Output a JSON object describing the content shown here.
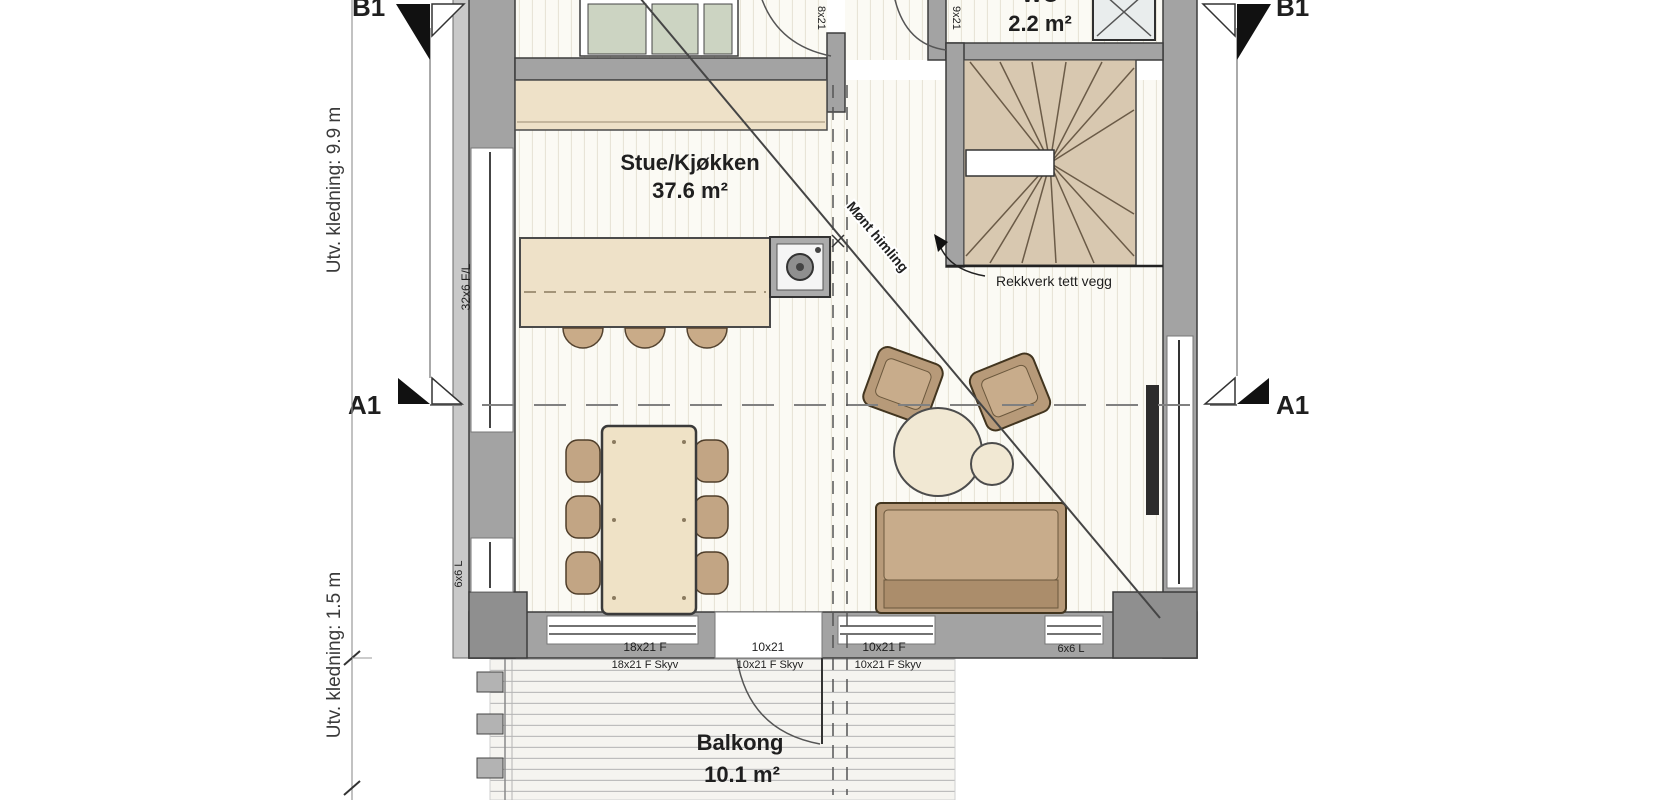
{
  "rooms": {
    "living_kitchen": {
      "name": "Stue/Kjøkken",
      "area": "37.6 m²"
    },
    "wc": {
      "name": "WC",
      "area": "2.2 m²"
    },
    "balcony": {
      "name": "Balkong",
      "area": "10.1 m²"
    }
  },
  "sections": {
    "a1": "A1",
    "b1": "B1"
  },
  "dimensions": {
    "cladding_upper": "Utv. kledning: 9.9 m",
    "cladding_lower": "Utv. kledning: 1.5 m"
  },
  "notes": {
    "railing": "Rekkverk tett vegg",
    "ceiling": "Mønt himling",
    "cross": "×"
  },
  "openings": {
    "left_tall": "32x6 F/L",
    "left_small": "6x6 L",
    "bottom_right_window": "6x6 L",
    "bottom_row_top": [
      "18x21 F",
      "10x21",
      "10x21 F"
    ],
    "bottom_row_bottom": [
      "18x21 F Skyv",
      "10x21 F Skyv",
      "10x21 F Skyv"
    ],
    "top_left_door": "8x21",
    "top_right_door": "9x21"
  },
  "colors": {
    "wall": "#a3a3a3",
    "wall_dark": "#3d3d3d",
    "floor": "#fbfaf4",
    "counter": "#eee1c8",
    "stair": "#d8c8b0",
    "cabinet": "#ccd4c2",
    "furniture": "#b79a79",
    "ink": "#1f1f1f"
  }
}
